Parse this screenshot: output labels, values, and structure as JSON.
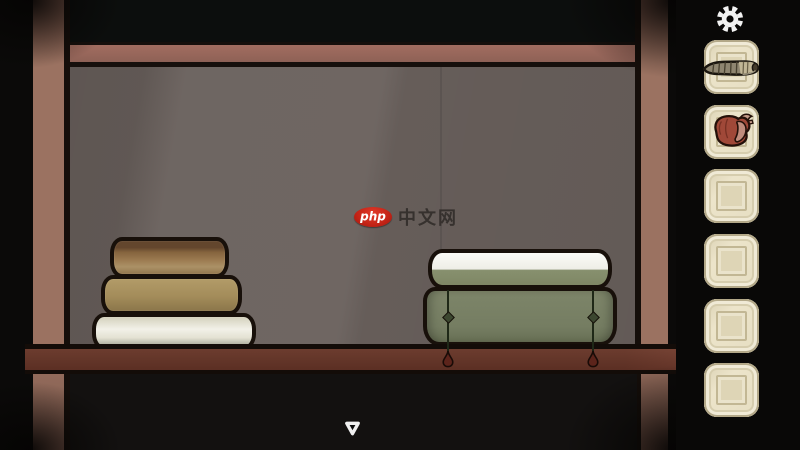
{
  "window": {
    "width": 800,
    "height": 450,
    "type": "point-and-click adventure scene"
  },
  "watermark": {
    "logo": "php",
    "text": "中文网"
  },
  "hud": {
    "settings": {
      "icon": "gear-icon"
    },
    "inventory": {
      "slot_count": 6,
      "slots": [
        {
          "index": 1,
          "item": "cigar",
          "icon": "cigar-icon",
          "empty": false
        },
        {
          "index": 2,
          "item": "heart",
          "icon": "heart-icon",
          "empty": false
        },
        {
          "index": 3,
          "item": "",
          "icon": "",
          "empty": true
        },
        {
          "index": 4,
          "item": "",
          "icon": "",
          "empty": true
        },
        {
          "index": 5,
          "item": "",
          "icon": "",
          "empty": true
        },
        {
          "index": 6,
          "item": "",
          "icon": "",
          "empty": true
        }
      ]
    },
    "navigation": {
      "down_arrow_icon": "triangle-down-icon"
    }
  },
  "scene": {
    "description": "dark cabinet interior with wooden frame and shelf",
    "objects": [
      {
        "name": "book-stack",
        "position": "left-on-shelf",
        "books": [
          {
            "order": "top",
            "color": "#9c7b51"
          },
          {
            "order": "middle",
            "color": "#a38c5a"
          },
          {
            "order": "bottom",
            "color": "#eeede4"
          }
        ]
      },
      {
        "name": "white-green-book",
        "position": "right-on-top-of-box"
      },
      {
        "name": "green-box",
        "position": "right-on-shelf",
        "cords": 2,
        "cord_bobs": 2
      }
    ]
  },
  "colors": {
    "background": "#0a0908",
    "wall": "#69605c",
    "frame_post": "#9b7261",
    "top_rail": "#9c6a5e",
    "shelf": "#a37a6b",
    "slot_beige": "#e6dec2",
    "box_green": "#757d62",
    "logo_red": "#c32316",
    "gear_white": "#f2f2f2",
    "outline_black": "#18100a"
  }
}
